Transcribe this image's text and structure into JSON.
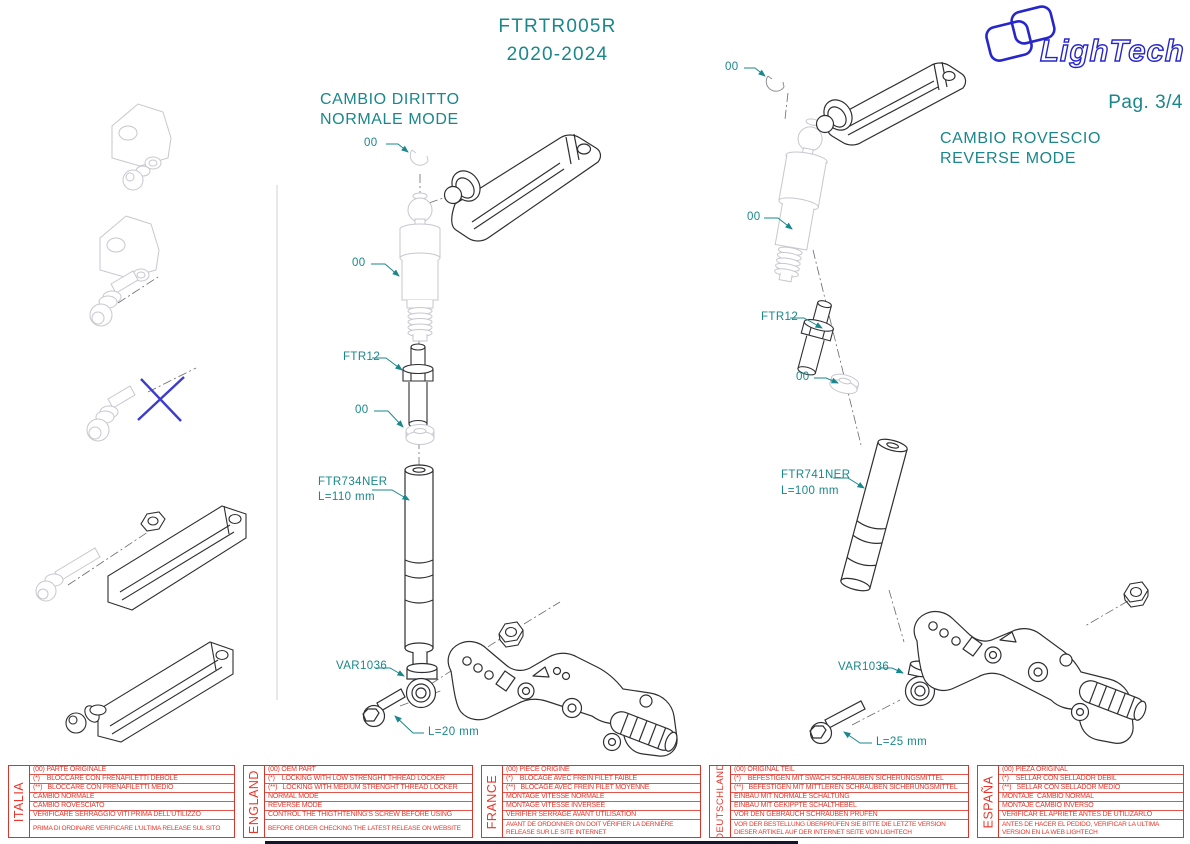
{
  "page": {
    "title_line1": "FTRTR005R",
    "title_line2": "2020-2024",
    "page_number": "Pag. 3/4",
    "logo_text": "LighTech"
  },
  "colors": {
    "teal": "#1a878b",
    "red": "#e8352a",
    "logo_blue": "#2626cb",
    "cross_blue": "#3c3ccd"
  },
  "assemblies": {
    "left": {
      "title": [
        "CAMBIO DIRITTO",
        "NORMALE MODE"
      ],
      "labels": {
        "clip": "00",
        "actuator": "00",
        "pin": "FTR12",
        "washer": "00",
        "rod_code": "FTR734NER",
        "rod_length": "L=110 mm",
        "rod_end": "VAR1036",
        "screw_length": "L=20 mm"
      }
    },
    "right": {
      "title": [
        "CAMBIO ROVESCIO",
        "REVERSE MODE"
      ],
      "labels": {
        "clip": "00",
        "actuator": "00",
        "pin": "FTR12",
        "washer": "00",
        "rod_code": "FTR741NER",
        "rod_length": "L=100 mm",
        "rod_end": "VAR1036",
        "screw_length": "L=25 mm"
      }
    }
  },
  "table": {
    "languages": [
      {
        "name": "ITALIA",
        "rows": [
          "(00) PARTE ORIGINALE",
          "(*)    BLOCCARE CON FRENAFILETTI DEBOLE",
          "(**)   BLOCCARE CON FRENAFILETTI MEDIO",
          "CAMBIO NORMALE",
          "CAMBIO ROVESCIATO",
          "VERIFICARE SERRAGGIO VITI PRIMA DELL'UTILIZZO"
        ],
        "footer": "PRIMA DI ORDINARE VERIFICARE L'ULTIMA RELEASE SUL SITO"
      },
      {
        "name": "ENGLAND",
        "rows": [
          "(00) OEM PART",
          "(*)    LOCKING WITH LOW STRENGHT THREAD LOCKER",
          "(**)   LOCKING WITH MEDIUM STRENGHT THREAD LOCKER",
          "NORMAL MODE",
          "REVERSE MODE",
          "CONTROL THE THIGTHTENING'S SCREW BEFORE USING"
        ],
        "footer": "BEFORE ORDER CHECKING THE LATEST RELEASE ON WEBSITE"
      },
      {
        "name": "FRANCE",
        "rows": [
          "(00) PIECE ORIGINE",
          "(*)    BLOCAGE AVEC FREIN FILET FAIBLE",
          "(**)   BLOCAGE AVEC FREIN FILET MOYENNE",
          "MONTAGE VITESSE NORMALE",
          "MONTAGE VITESSE INVERSEE",
          "VERIFIER SERRAGE AVANT UTILISATION"
        ],
        "footer": "AVANT DE ORDONNER ON DOIT VÉRIFIER LA DERNIÈRE RELEASE SUR LE SITE INTERNET"
      },
      {
        "name": "DEUTSCHLAND",
        "rows": [
          "(00) ORIGINAL TEIL",
          "(*)    BEFESTIGEN MIT SWACH SCHRAUBEN SICHERUNGSMITTEL",
          "(**)   BEFESTIGEN MIT MITTLEREN SCHRAUBEN SICHERUNGSMITTEL",
          "EINBAU MIT NORMALE SCHALTUNG",
          "EINBAU MIT GEKIPPTE SCHALTHEBEL",
          "VOR DEN GEBRAUCH SCHRAUBEN PRÜFEN"
        ],
        "footer": "VOR DER BESTELLUNG ÜBERPRÜFEN SIE BITTE DIE LETZTE VERSION DIESER ARTIKEL AUF DER INTERNET SEITE VON LIGHTECH"
      },
      {
        "name": "ESPAÑA",
        "rows": [
          "(00) PIEZA ORIGINAL",
          "(*)    SELLAR CON SELLADOR DEBIL",
          "(**)   SELLAR CON SELLADOR MEDIO",
          "MONTAJE  CAMBIO NORMAL",
          "MONTAJE CAMBIO INVERSO",
          "VERIFICAR EL APRIETE ANTES DE UTILIZARLO"
        ],
        "footer": "ANTES DE HACER EL PEDIDO, VERIFICAR LA ULTIMA VERSION EN LA WEB LIGHTECH"
      }
    ]
  }
}
